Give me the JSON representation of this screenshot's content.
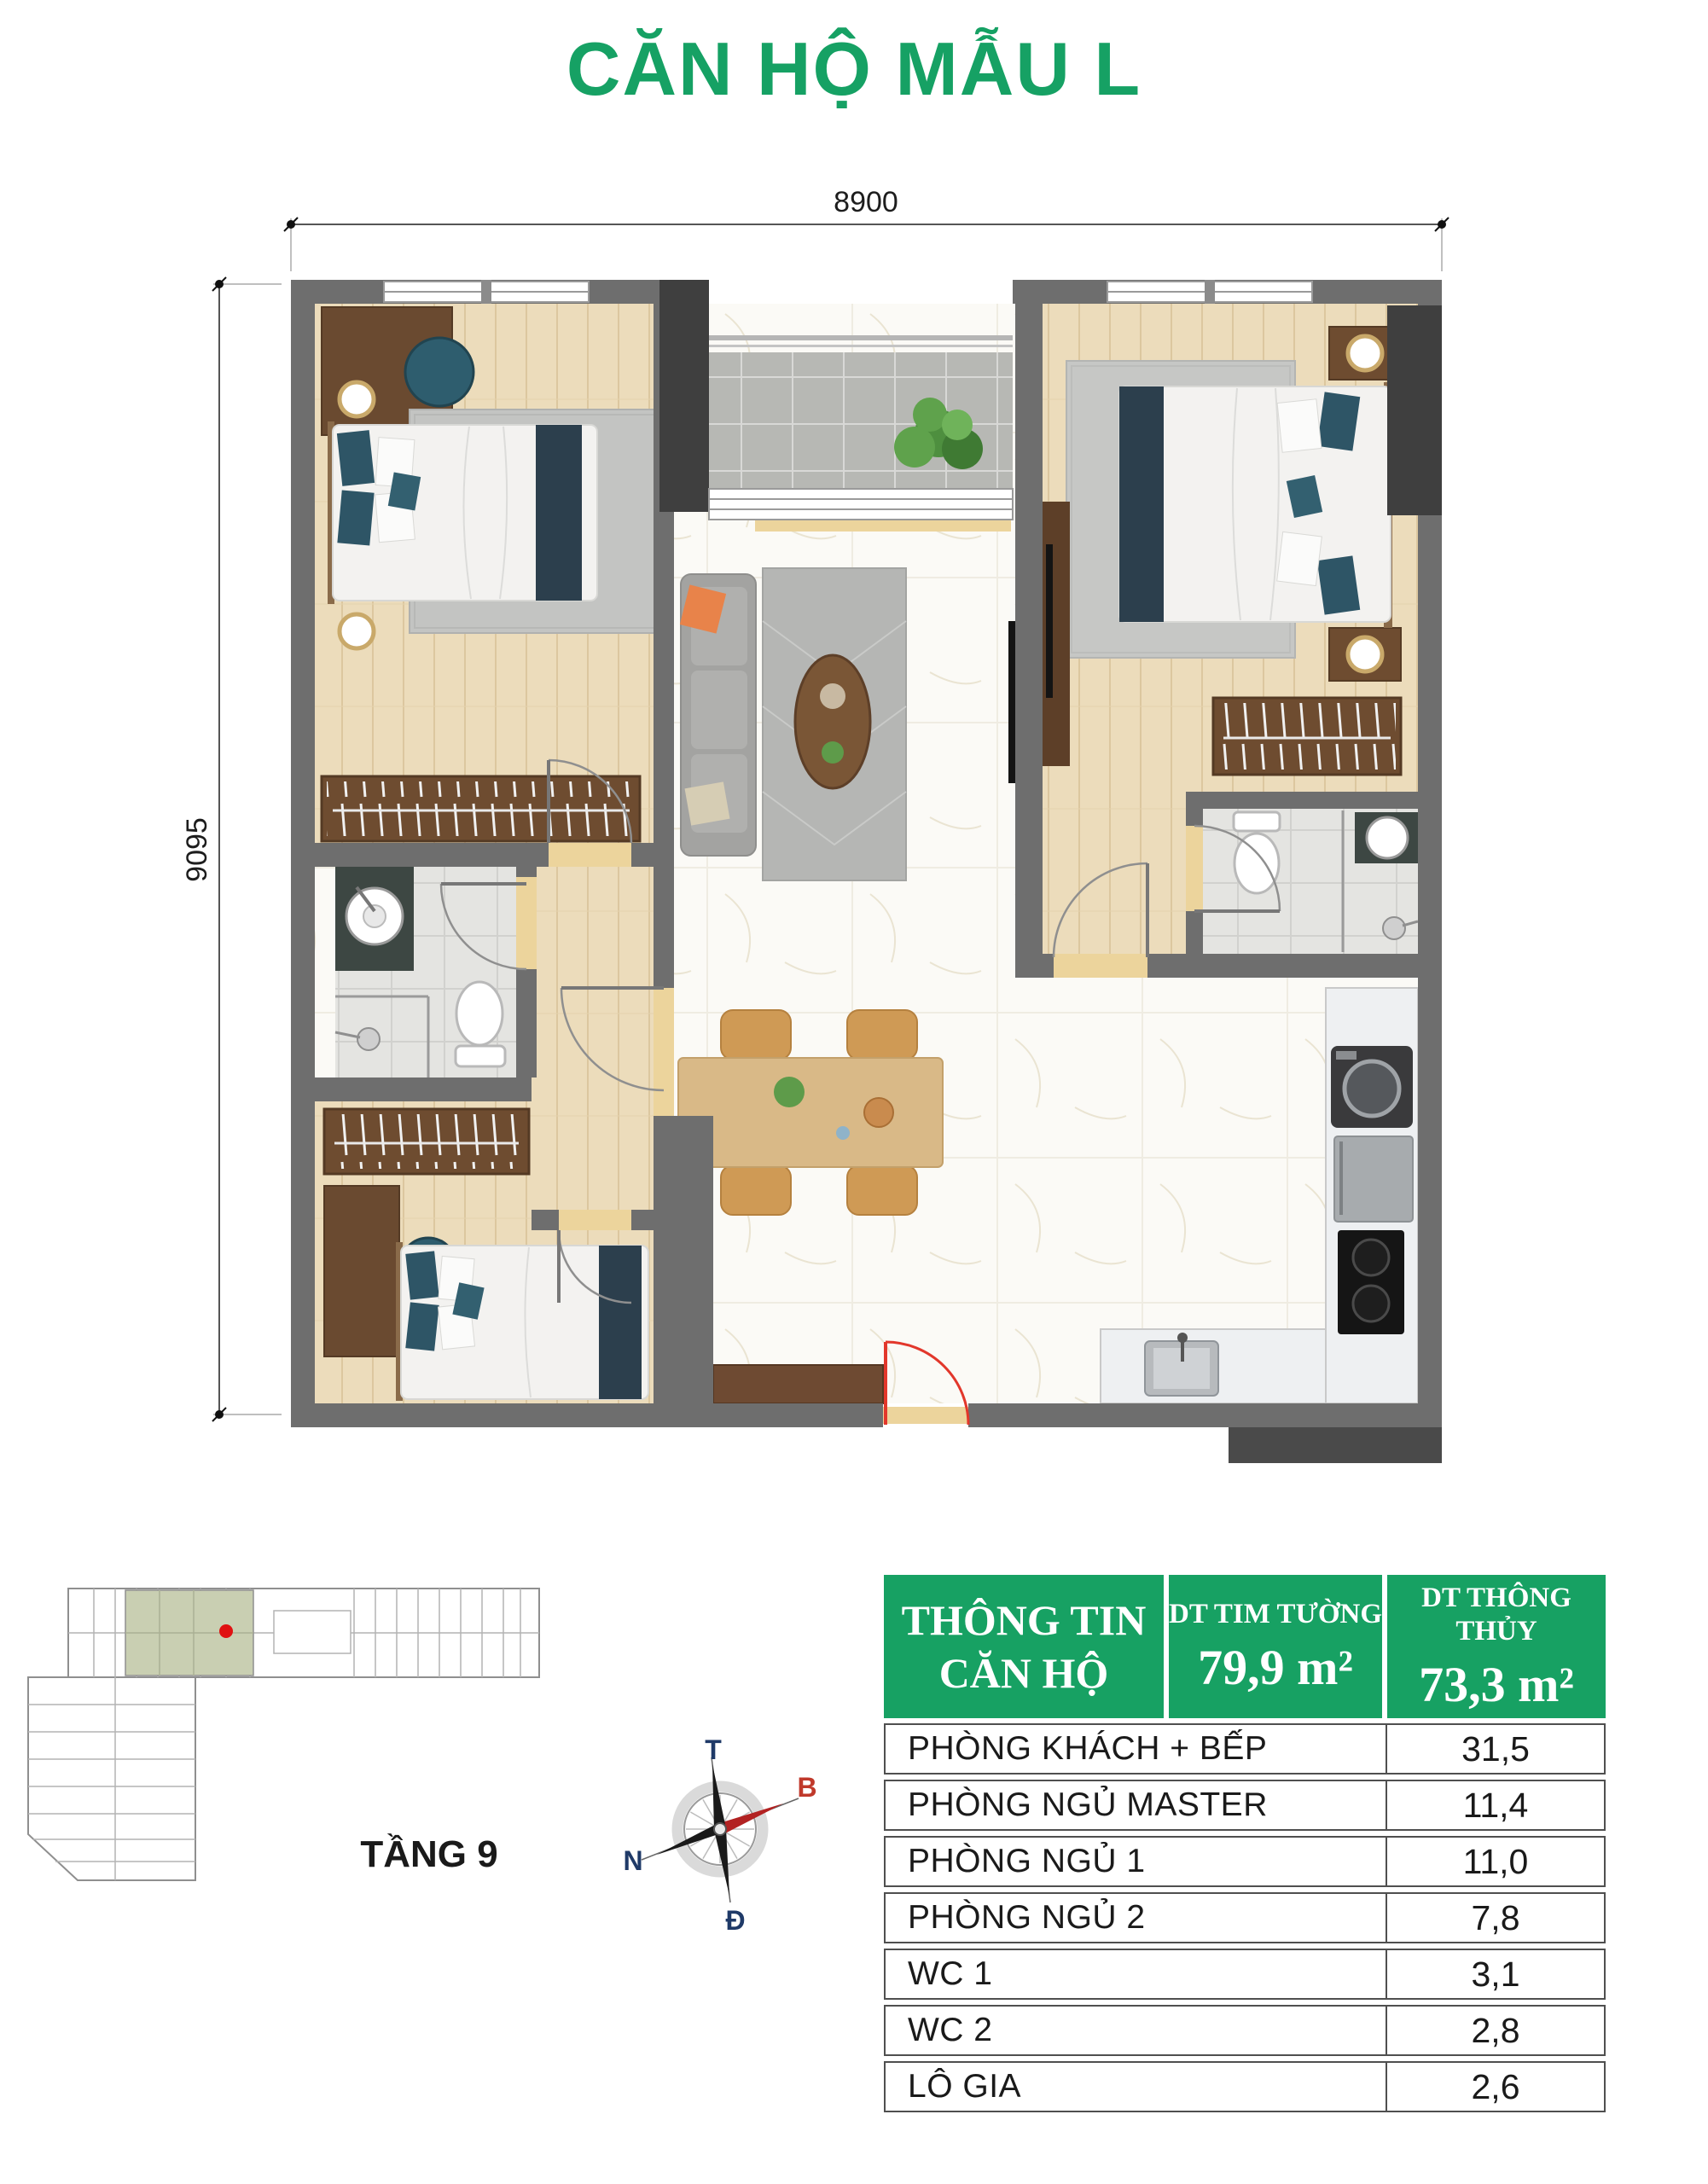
{
  "page_title": "CĂN HỘ MẪU L",
  "floor_plan": {
    "dimension_top": "8900",
    "dimension_left": "9095"
  },
  "key_plan": {
    "floor_label": "TẦNG 9",
    "highlight_color": "#c9cfb2"
  },
  "compass": {
    "label_top": "T",
    "label_upper_right": "B",
    "label_left": "N",
    "label_bottom": "Đ"
  },
  "info_table": {
    "header": {
      "title_line1": "THÔNG TIN",
      "title_line2": "CĂN HỘ",
      "col2_label": "DT TIM TƯỜNG",
      "col2_value": "79,9 m²",
      "col3_label": "DT THÔNG THỦY",
      "col3_value": "73,3 m²"
    },
    "rows": [
      {
        "label": "PHÒNG KHÁCH + BẾP",
        "value": "31,5"
      },
      {
        "label": "PHÒNG NGỦ MASTER",
        "value": "11,4"
      },
      {
        "label": "PHÒNG NGỦ 1",
        "value": "11,0"
      },
      {
        "label": "PHÒNG NGỦ 2",
        "value": "7,8"
      },
      {
        "label": "WC 1",
        "value": "3,1"
      },
      {
        "label": "WC 2",
        "value": "2,8"
      },
      {
        "label": "LÔ GIA",
        "value": "2,6"
      }
    ]
  },
  "colors": {
    "accent_green": "#17a163",
    "wall_gray": "#6e6e6e",
    "wall_dark": "#3f3f3f",
    "door_red": "#e2372b",
    "compass_north_red": "#c0392b",
    "compass_navy": "#1f3a68"
  }
}
